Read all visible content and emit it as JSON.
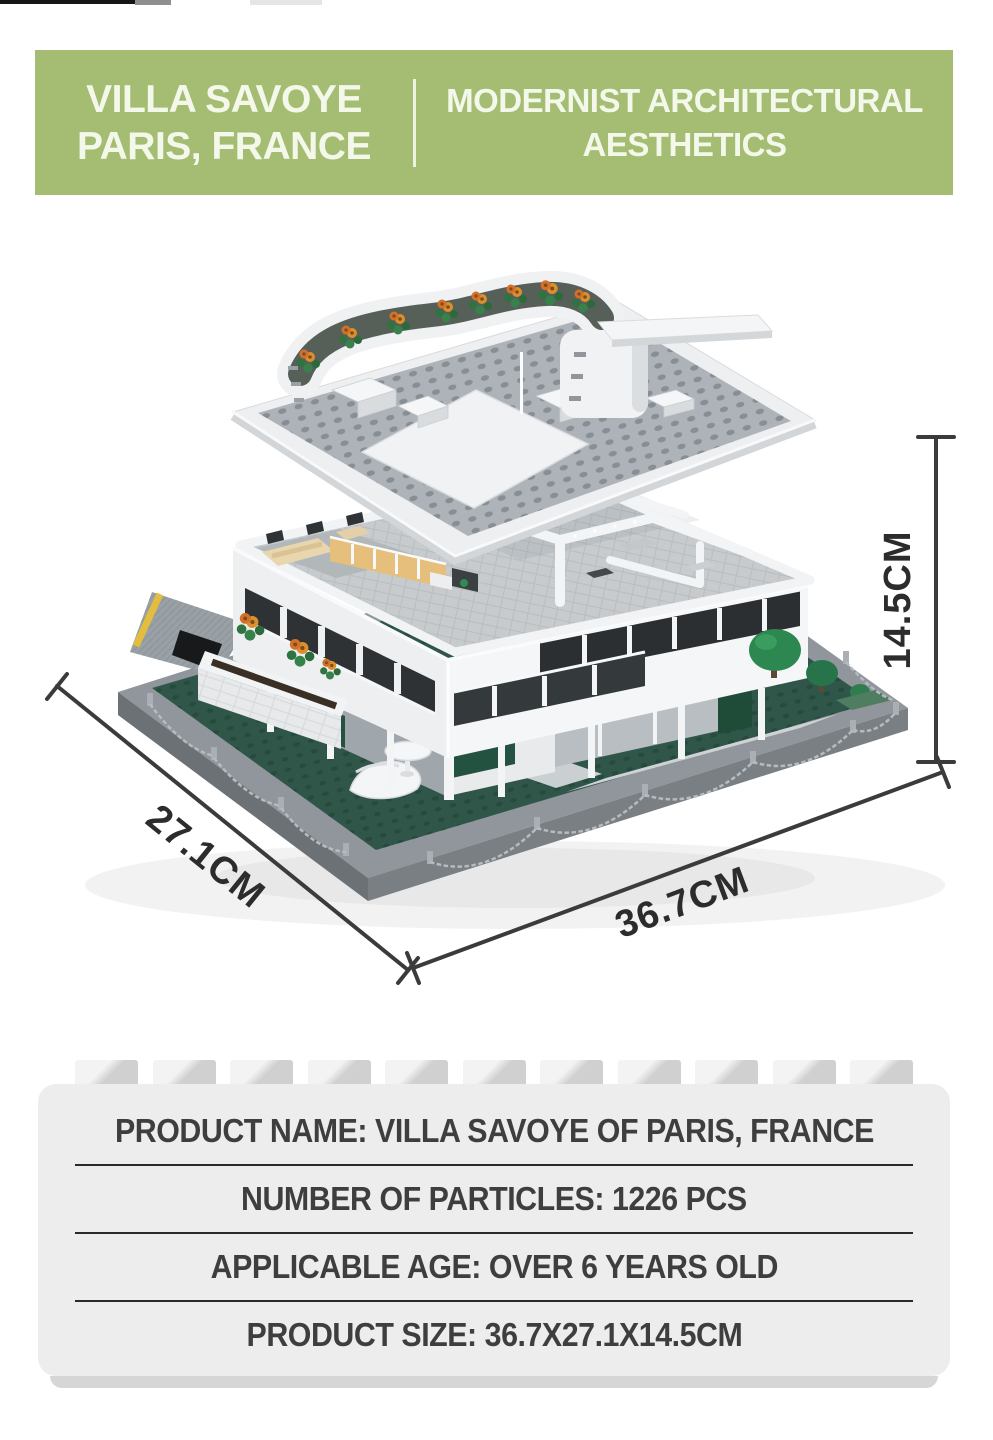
{
  "header": {
    "bg_color": "#a4bd72",
    "divider_color": "#f2f6e7",
    "text_color": "#f4f8ea",
    "left": {
      "line1": "VILLA SAVOYE",
      "line2": "PARIS, FRANCE"
    },
    "right": {
      "line1": "MODERNIST ARCHITECTURAL",
      "line2": "AESTHETICS"
    }
  },
  "diagram": {
    "subject": "Villa Savoye building-block model shown in exploded view with floating roof-garden plate above the house on a dark gray base plate",
    "dimension_height": "14.5CM",
    "dimension_depth": "27.1CM",
    "dimension_width": "36.7CM",
    "line_color": "#3b3b3b"
  },
  "specs": {
    "divider_color": "#2a2a2a",
    "rows": [
      {
        "label": "PRODUCT NAME",
        "value": "VILLA SAVOYE OF PARIS, FRANCE",
        "text": "PRODUCT NAME: VILLA SAVOYE OF PARIS, FRANCE"
      },
      {
        "label": "NUMBER OF PARTICLES",
        "value": "1226 PCS",
        "text": "NUMBER OF PARTICLES: 1226 PCS"
      },
      {
        "label": "APPLICABLE AGE",
        "value": "OVER 6 YEARS OLD",
        "text": "APPLICABLE AGE: OVER 6 YEARS OLD"
      },
      {
        "label": "PRODUCT SIZE",
        "value": "36.7X27.1X14.5CM",
        "text": "PRODUCT SIZE: 36.7X27.1X14.5CM"
      }
    ]
  }
}
